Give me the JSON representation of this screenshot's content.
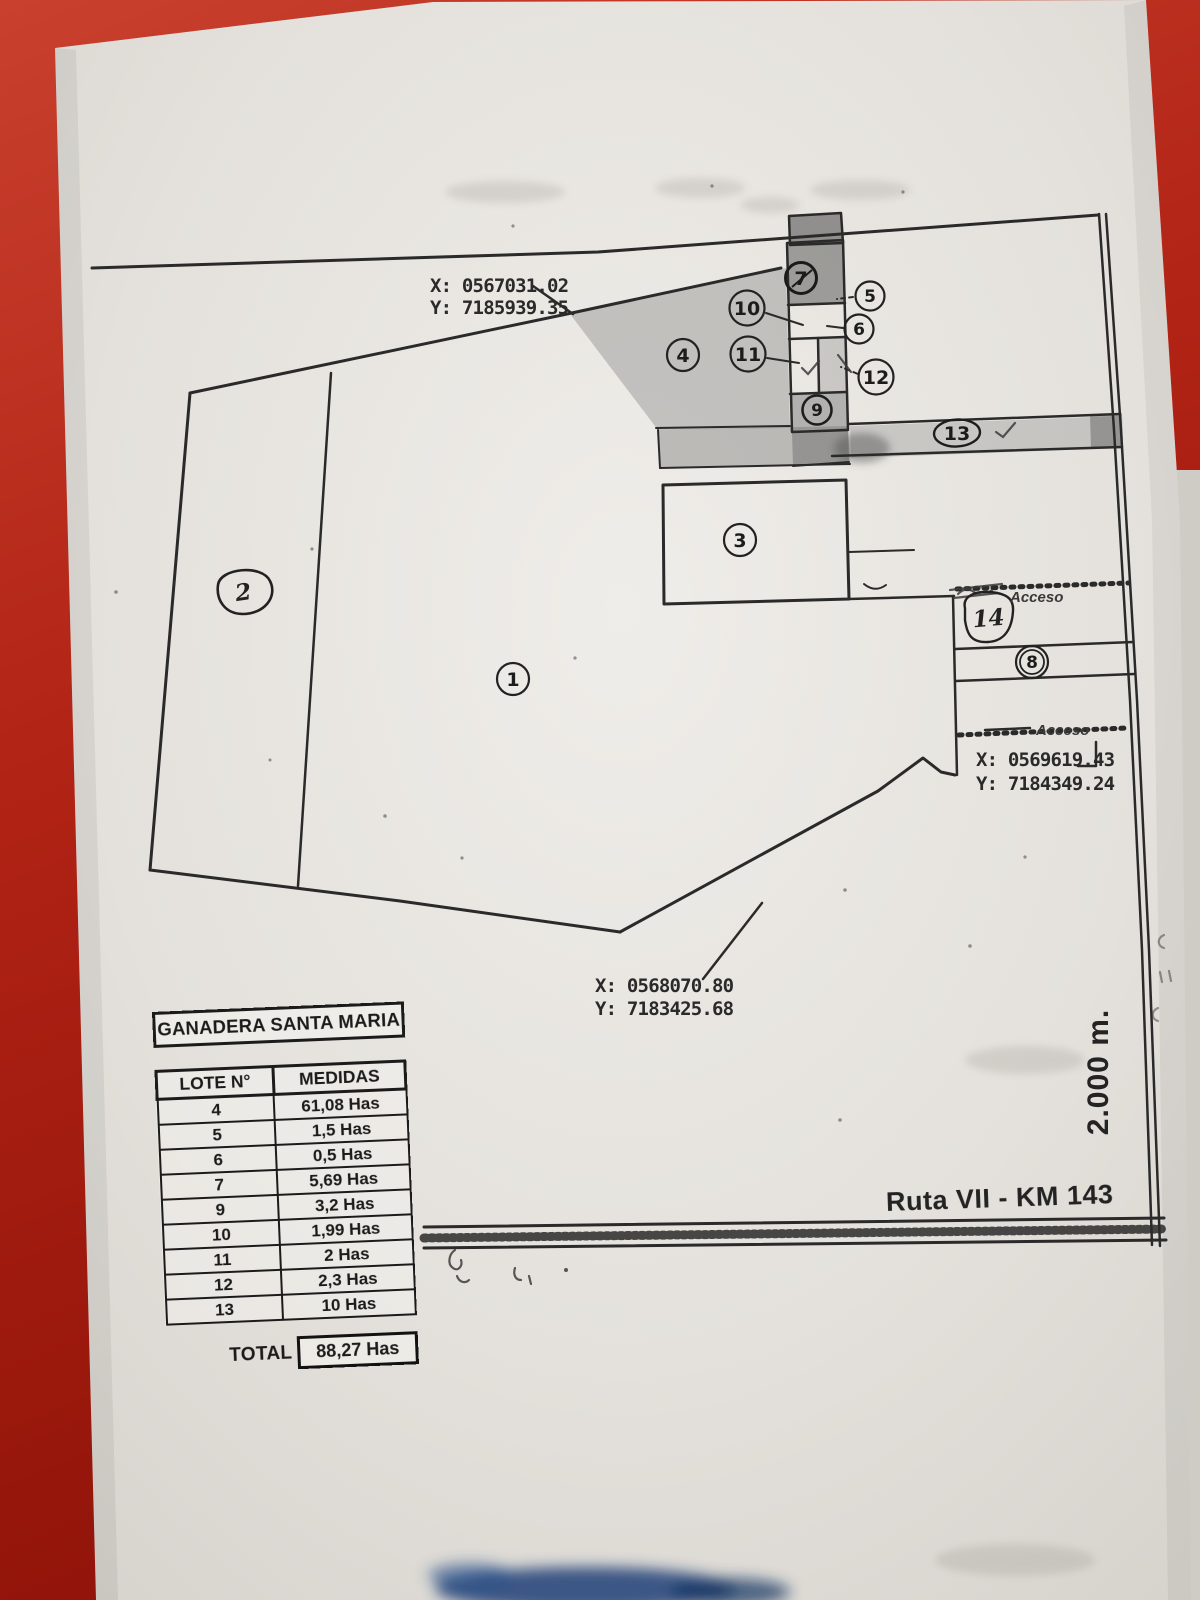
{
  "map": {
    "coordinates": {
      "top": {
        "x": "X: 0567031.02",
        "y": "Y: 7185939.35"
      },
      "right": {
        "x": "X: 0569619.43",
        "y": "Y: 7184349.24"
      },
      "bottom": {
        "x": "X: 0568070.80",
        "y": "Y: 7183425.68"
      }
    },
    "access_labels": {
      "upper": "Acceso",
      "lower": "Acceso"
    },
    "scale_label": "2.000 m.",
    "route_label": "Ruta VII - KM 143",
    "markers": {
      "m1": "1",
      "m2": "2",
      "m3": "3",
      "m4": "4",
      "m5": "5",
      "m6": "6",
      "m7": "7",
      "m8": "8",
      "m9": "9",
      "m10": "10",
      "m11": "11",
      "m12": "12",
      "m13": "13",
      "m14": "14"
    }
  },
  "table": {
    "title": "GANADERA SANTA MARIA",
    "columns": [
      "LOTE N°",
      "MEDIDAS"
    ],
    "rows": [
      [
        "4",
        "61,08 Has"
      ],
      [
        "5",
        "1,5 Has"
      ],
      [
        "6",
        "0,5 Has"
      ],
      [
        "7",
        "5,69 Has"
      ],
      [
        "9",
        "3,2 Has"
      ],
      [
        "10",
        "1,99 Has"
      ],
      [
        "11",
        "2 Has"
      ],
      [
        "12",
        "2,3 Has"
      ],
      [
        "13",
        "10 Has"
      ]
    ],
    "total_label": "TOTAL",
    "total_value": "88,27 Has"
  },
  "colors": {
    "background_red": "#b12315",
    "paper": "#e7e4df",
    "ink": "#262626"
  }
}
